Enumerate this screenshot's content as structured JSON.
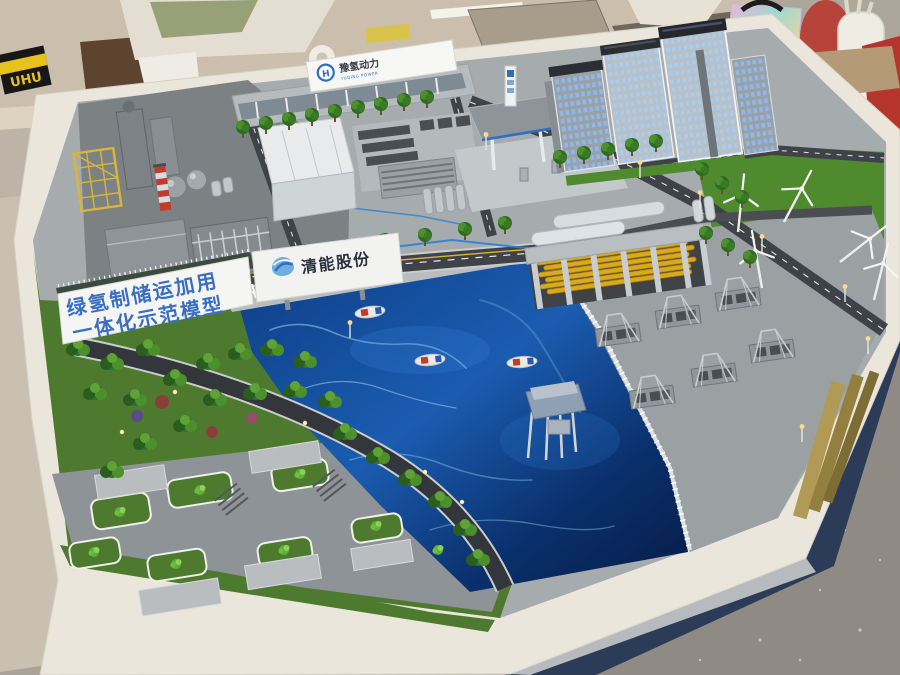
{
  "scene": {
    "type": "photograph",
    "subject": "Architectural scale model of a green-hydrogen industrial park displayed on a white table",
    "setting": "model-making workshop with cluttered workbench and concrete floor"
  },
  "signs": {
    "banner_wall": {
      "line1": "绿氢制储运加用",
      "line2": "一体化示范模型"
    },
    "gate_sign": {
      "text": "清能股份"
    },
    "entrance_sign": {
      "logo_letter": "H",
      "cn": "豫氢动力",
      "en": "YUQING POWER"
    }
  },
  "workbench": {
    "glue_box_label": "UHU"
  },
  "model_features": {
    "industrial_plant": "hydrogen production plant with yellow pipe-rack tower, process columns, spherical tanks and red-white striped chimney",
    "refueling_station": "hydrogen refueling station with gray canopy and price pylon",
    "office_towers": "high-rise towers with lit blue windows",
    "storage": "tube-bundle hydrogen storage hall with yellow cylinders and compressor skids",
    "water": "harbor basin with cargo boats and an offshore platform",
    "wind_farm": "white wind turbines on a lawn",
    "park": "landscaped garden with curved road and lit parking lot",
    "counts": {
      "boats": 3,
      "wind_turbines": 5
    }
  },
  "colors": {
    "banner_text_blue": "#3a6ec2",
    "brand_blue": "#2f6fc1",
    "water_deep": "#0a2f6b",
    "water_light": "#2f7fd4",
    "grass_green": "#4d7a2e",
    "storage_tube_yellow": "#d9a91f",
    "chimney_red": "#c23b2a",
    "table_white": "#eae6dc",
    "table_skirt_navy": "#2c3c58"
  }
}
